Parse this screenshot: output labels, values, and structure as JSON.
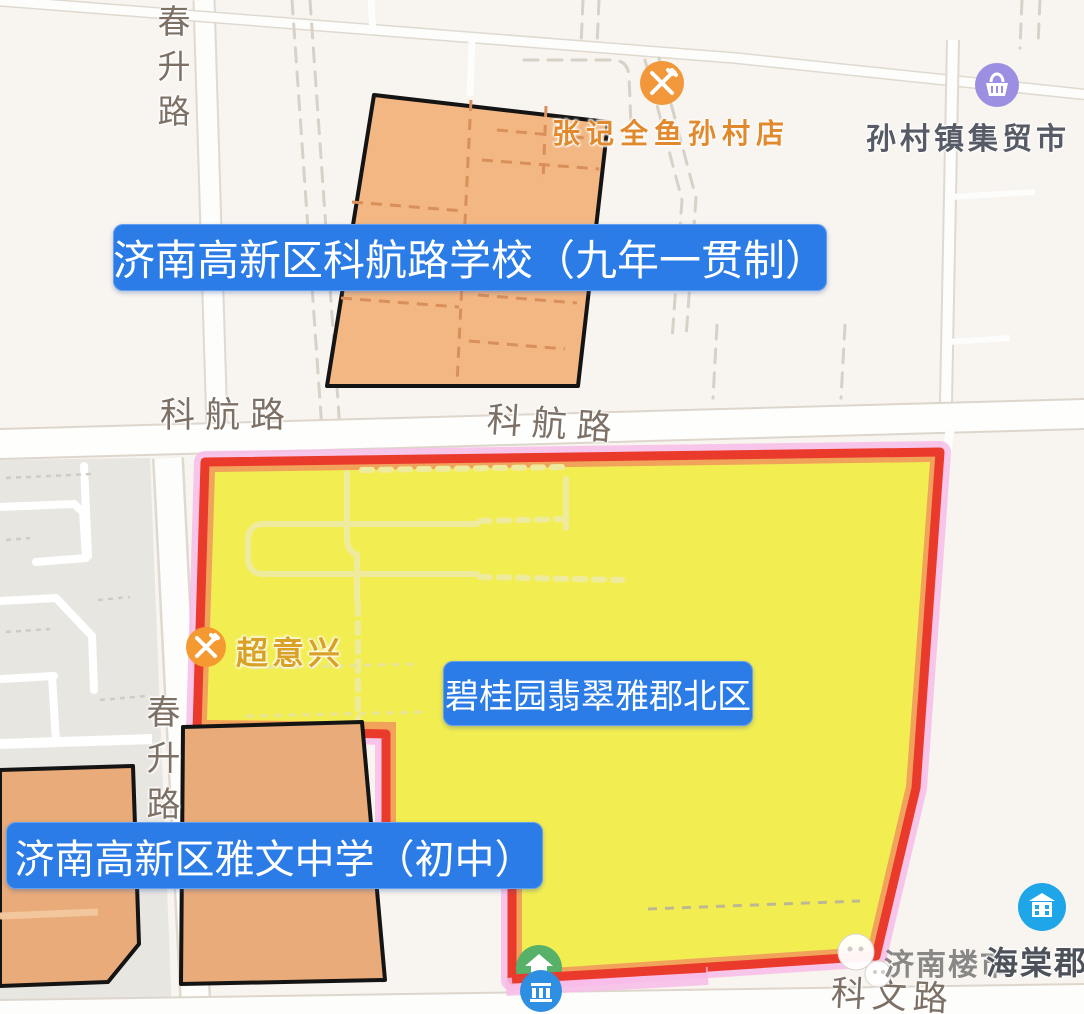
{
  "overlay_labels": {
    "kehang_school": "济南高新区科航路学校（九年一贯制）",
    "district": "碧桂园翡翠雅郡北区",
    "yawen_school": "济南高新区雅文中学（初中）"
  },
  "roads": {
    "chunsheng_top": "春升路",
    "chunsheng_mid": "春升路",
    "kehang_left": "科航路",
    "kehang_right": "科航路",
    "kewen": "科文路"
  },
  "pois": {
    "zhangji": {
      "name": "张记全鱼孙村店",
      "icon": "restaurant-icon"
    },
    "market": {
      "name": "孙村镇集贸市",
      "icon": "market-icon"
    },
    "chaoyixing": {
      "name": "超意兴",
      "icon": "restaurant-icon"
    },
    "haitang": {
      "name": "海棠郡",
      "icon": "community-icon"
    }
  },
  "watermark": {
    "text": "济南楼市",
    "icon": "chat-logo-icon"
  },
  "colors": {
    "label_bg": "#2b7ce6",
    "district_fill": "#f2ee52",
    "district_border": "#ea3a2c",
    "district_glow": "#f8bce9",
    "district_band": "#f1a35c",
    "school_fill": "#f3b783",
    "poi_orange": "#f2983b",
    "poi_purple": "#9c8fe2",
    "poi_blue": "#1fa6e8",
    "poi_green": "#57b169"
  }
}
